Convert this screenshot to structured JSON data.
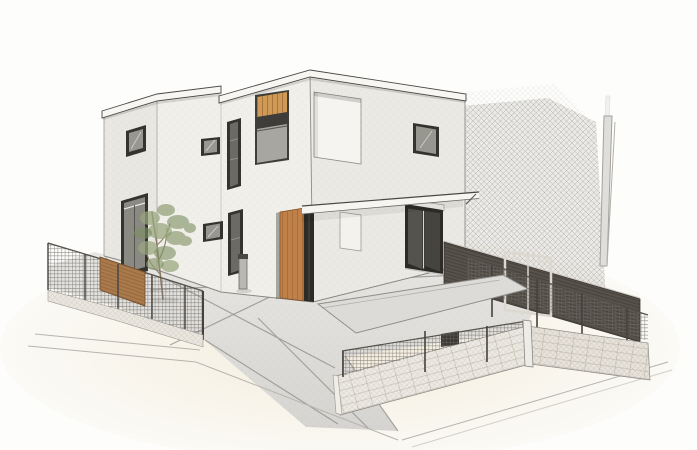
{
  "scene": {
    "title": "Exterior perspective sketch",
    "style": "pencil-and-watercolor architectural rendering",
    "description": "Hand-drawn style exterior rendering of a modern two-storey flat-roof house with white rendered walls, dark-framed windows, a vertical-plank wood entrance door, a wood-louver accent niche, a recessed balcony opening, a long thin entrance canopy, a small garden tree, a grey bollard, concrete paving with joint lines, mesh fences with a wood-slat section on low block walls, a dark horizontal-slat fence with a white gate frame on the right, pencil crosshatch background shading and a utility pole."
  },
  "objects": {
    "house": "two-storey flat-roof house with white render walls",
    "entrance_door": "vertical-plank wood entrance door with dark sidelight",
    "wood_louver_niche": "wood slat accent niche on upper front facade",
    "balcony_opening": "recessed white balcony opening on upper right facade",
    "windows": "dark-framed windows of various sizes",
    "canopy": "thin flat canopy over entrance and terrace",
    "tree": "small deciduous garden tree",
    "bollard": "grey utility bollard near entrance path",
    "driveway": "concrete paved driveway and terrace with joint lines",
    "left_fence": "mesh fence with wood slat section on low block wall",
    "front_fence": "mesh fence on block retaining wall with small dark vent box",
    "right_fence": "dark horizontal-slat fence with white gate frame",
    "utility_pole": "utility pole at right boundary",
    "background_shading": "pencil crosshatch shading behind right fence"
  },
  "colors": {
    "background": "#fdfdfc",
    "ground_wash": "#f3ebd9",
    "concrete_light": "#e7e6e2",
    "concrete_dark": "#d5d4d0",
    "concrete_slab": "#dcdbd7",
    "hatch_tint": "#c8c5c0",
    "hatch": "#8d8a86",
    "mesh_line": "#6f6c68",
    "slat_line": "#3c3833",
    "wood_plank_line": "#8a5526",
    "block_line": "#9a9181",
    "wall_west": "#e9e7e1",
    "wall_front": "#f0efe9",
    "wall_right": "#ebe9e3",
    "fascia": "#f7f6f2",
    "canopy": "#f6f5f1",
    "ink": "#4a4845",
    "line_soft": "#8f8d89",
    "street_line": "#b7b4af",
    "window_frame": "#34332f",
    "glass": "#97968f",
    "glass_dark": "#6b6a64",
    "glass_deep": "#2c2b28",
    "balcony_white": "#f5f4f0",
    "panel_white": "#f3f2ee",
    "wood_door": "#c08049",
    "wood_slats": "#cf9a55",
    "wood_fence": "#a87b4e",
    "dark_fence": "#57524a",
    "gate_white": "#dcd8d0",
    "block_wall": "#ece9e2",
    "block_wall_side": "#e7e3db",
    "pole": "#e0deda",
    "trunk": "#8b7b66",
    "foliage_1": "#9aa87e",
    "foliage_2": "#8a9a6e",
    "foliage_3": "#7d8f63",
    "bollard": "#b9b7b2",
    "post_dark": "#45423e",
    "cap_light": "#cfcbc3"
  }
}
